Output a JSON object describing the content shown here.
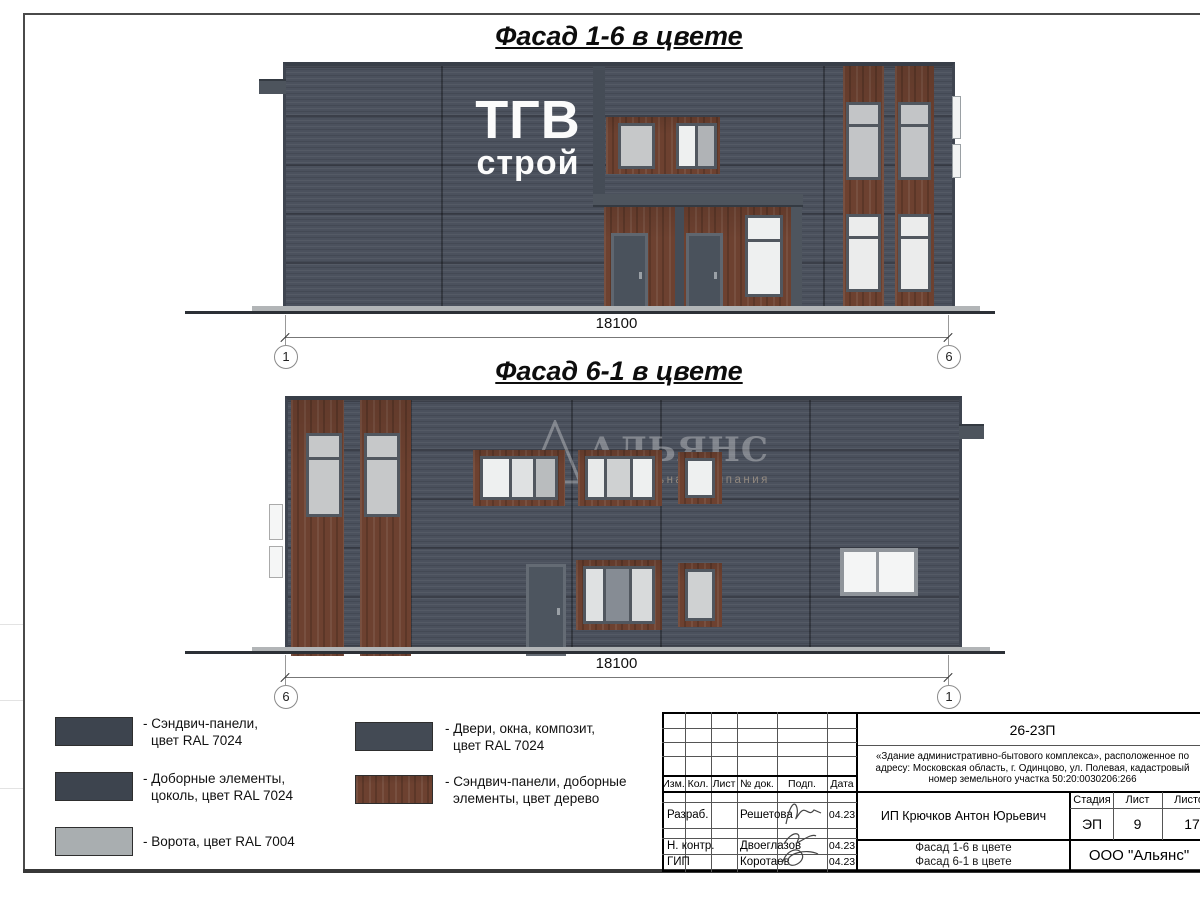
{
  "titles": {
    "facade_1_6": "Фасад 1-6 в цвете",
    "facade_6_1": "Фасад 6-1 в цвете"
  },
  "facade1": {
    "logo_top": "ТГВ",
    "logo_bottom": "строй",
    "dimension": "18100",
    "axis_left": "1",
    "axis_right": "6"
  },
  "facade2": {
    "dimension": "18100",
    "axis_left": "6",
    "axis_right": "1",
    "watermark_name": "АЛЬЯНС",
    "watermark_subtitle": "строительная компания"
  },
  "legend": {
    "items": [
      {
        "line1": "- Сэндвич-панели,",
        "line2": "цвет RAL 7024",
        "color": "#3d444e"
      },
      {
        "line1": "- Доборные элементы,",
        "line2": "цоколь, цвет RAL 7024",
        "color": "#3d444e"
      },
      {
        "line1": "- Ворота, цвет RAL 7004",
        "line2": "",
        "color": "#a9aeb0"
      },
      {
        "line1": "- Двери, окна, композит,",
        "line2": "цвет RAL 7024",
        "color": "#434a54"
      },
      {
        "line1": "- Сэндвич-панели, доборные",
        "line2": "элементы, цвет дерево",
        "color": "#6d4130"
      }
    ]
  },
  "titleblock": {
    "code": "26-23П",
    "description": "«Здание административно-бытового комплекса», расположенное по адресу: Московская область, г. Одинцово, ул. Полевая, кадастровый номер земельного участка 50:20:0030206:266",
    "client": "ИП Крючков Антон Юрьевич",
    "columns": {
      "izm": "Изм.",
      "kol": "Кол.",
      "list": "Лист",
      "doc": "№ док.",
      "podp": "Подп.",
      "data": "Дата"
    },
    "rows": [
      {
        "role": "Разраб.",
        "name": "Решетова",
        "date": "04.23"
      },
      {
        "role": "Н. контр.",
        "name": "Двоеглазов",
        "date": "04.23"
      },
      {
        "role": "ГИП",
        "name": "Коротаев",
        "date": "04.23"
      }
    ],
    "stage_label": "Стадия",
    "sheet_label": "Лист",
    "sheets_label": "Листов",
    "stage": "ЭП",
    "sheet_num": "9",
    "sheets_total": "17",
    "sheet_title_line1": "Фасад 1-6 в цвете",
    "sheet_title_line2": "Фасад 6-1 в цвете",
    "company": "ООО \"Альянс\""
  },
  "colors": {
    "facade_gray_ral7024": "#3d444e",
    "wall_render": "#4b515d",
    "wood": "#6d4130",
    "gate_ral7004": "#a9aeb0",
    "glass": "#c9cacb"
  }
}
